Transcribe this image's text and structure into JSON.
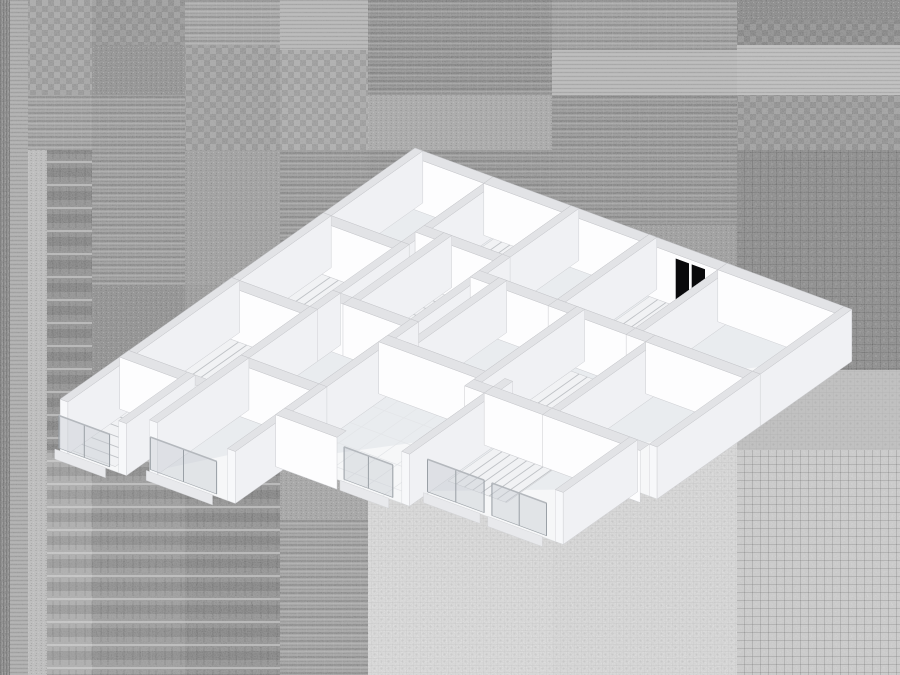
{
  "scene": {
    "width": 900,
    "height": 675,
    "description": "axonometric cutaway floor-plan model on glitch noise patchwork background"
  },
  "palette": {
    "wall_face": "#fdfdfe",
    "wall_side": "#f0f1f4",
    "wall_top": "#e2e3e6",
    "wall_cap": "#ececef",
    "wall_cap2": "#f7f8fa",
    "top_stroke": "#c5c6ca",
    "outline": "#cfd0d4",
    "floor": "#f6f7f8",
    "floor_stroke": "#dadcdf",
    "floor_shade": "#e6e8ec",
    "stair": "#f1f2f4",
    "stair_stroke": "#c7c9cc",
    "tread": "#bfc2c6",
    "door": "#0a0a0c",
    "glass": "#c7ccd2",
    "glass_frame": "#9aa0a6",
    "rail": "#b4b8bd",
    "curb": "#e8e9ec",
    "grid_line": "#e3e5e8"
  },
  "background": {
    "blocks": [
      [
        0,
        0,
        10,
        675,
        "#6f6f6f",
        "v3"
      ],
      [
        10,
        0,
        18,
        675,
        "#a6a6a6",
        "h4"
      ],
      [
        28,
        0,
        64,
        95,
        "#9b9b9b",
        "ch6"
      ],
      [
        28,
        95,
        64,
        55,
        "#999999",
        "h8"
      ],
      [
        28,
        150,
        19,
        525,
        "#c2c2c2",
        "fine"
      ],
      [
        47,
        150,
        45,
        300,
        "#7d7d7d",
        "rows22"
      ],
      [
        47,
        450,
        45,
        225,
        "#a8a8a8",
        "rows22"
      ],
      [
        92,
        0,
        93,
        45,
        "#8a8a8a",
        "ch6"
      ],
      [
        92,
        45,
        93,
        50,
        "#7e7e7e",
        "fine"
      ],
      [
        92,
        95,
        93,
        190,
        "#909090",
        "h8"
      ],
      [
        92,
        285,
        93,
        165,
        "#7b7b7b",
        "fine"
      ],
      [
        92,
        450,
        93,
        225,
        "#8d8d8d",
        "rows22"
      ],
      [
        185,
        0,
        95,
        45,
        "#a0a0a0",
        "h8"
      ],
      [
        185,
        45,
        95,
        105,
        "#979797",
        "ch6"
      ],
      [
        185,
        150,
        95,
        135,
        "#939393",
        "fine"
      ],
      [
        185,
        285,
        95,
        165,
        "#8c8c8c",
        "fine"
      ],
      [
        185,
        450,
        95,
        225,
        "#7e7e7e",
        "rows22"
      ],
      [
        280,
        0,
        88,
        50,
        "#b5b5b5",
        "h4"
      ],
      [
        280,
        50,
        88,
        100,
        "#a3a3a3",
        "ch6"
      ],
      [
        280,
        150,
        88,
        150,
        "#8d8d8d",
        "h8"
      ],
      [
        280,
        300,
        88,
        220,
        "#9c9c9c",
        "fine"
      ],
      [
        280,
        520,
        88,
        155,
        "#999999",
        "h8"
      ],
      [
        368,
        0,
        184,
        95,
        "#818181",
        "h8"
      ],
      [
        368,
        95,
        184,
        55,
        "#a2a2a2",
        "fine"
      ],
      [
        368,
        150,
        184,
        140,
        "#868686",
        "h8"
      ],
      [
        368,
        290,
        184,
        170,
        "#9b9b9b",
        "fine"
      ],
      [
        368,
        460,
        184,
        215,
        "#efefef",
        "dot6"
      ],
      [
        552,
        0,
        185,
        50,
        "#969696",
        "h8"
      ],
      [
        552,
        50,
        185,
        45,
        "#b9b9b9",
        "h4"
      ],
      [
        552,
        95,
        185,
        130,
        "#888888",
        "h8"
      ],
      [
        552,
        225,
        185,
        145,
        "#919191",
        "fine"
      ],
      [
        552,
        370,
        185,
        305,
        "#ececec",
        "dot6"
      ],
      [
        737,
        0,
        163,
        20,
        "#707070",
        "fine"
      ],
      [
        737,
        20,
        163,
        25,
        "#787878",
        "ch6"
      ],
      [
        737,
        45,
        163,
        50,
        "#c1c1c1",
        "h4"
      ],
      [
        737,
        95,
        163,
        55,
        "#8c8c8c",
        "ch6"
      ],
      [
        737,
        150,
        163,
        220,
        "#737373",
        "grid8"
      ],
      [
        737,
        370,
        163,
        80,
        "#c5c5c5",
        "dot6"
      ],
      [
        737,
        450,
        163,
        225,
        "#d8d8d8",
        "grid8"
      ]
    ]
  },
  "floorplan": {
    "origin": [
      415,
      200
    ],
    "axis_u": [
      19.5,
      7.2
    ],
    "axis_v": [
      -22.9,
      16.2
    ],
    "wall_height": 52,
    "wall_thickness": 0.4,
    "rooms": [
      [
        0,
        0,
        4,
        4,
        ""
      ],
      [
        4,
        0,
        4,
        3,
        ""
      ],
      [
        8,
        0,
        4,
        4,
        ""
      ],
      [
        12,
        0,
        4,
        4,
        ""
      ],
      [
        16,
        0,
        6,
        4,
        ""
      ],
      [
        0,
        4,
        4,
        4,
        ""
      ],
      [
        5,
        3,
        3,
        4,
        ""
      ],
      [
        9,
        4,
        4,
        4,
        ""
      ],
      [
        13,
        4,
        4,
        4.5,
        ""
      ],
      [
        17,
        4,
        5,
        4.5,
        ""
      ],
      [
        0,
        8,
        4,
        4.5,
        ""
      ],
      [
        4,
        7,
        4,
        4,
        ""
      ],
      [
        8,
        8,
        6,
        4.5,
        "sg"
      ],
      [
        14,
        8.5,
        7,
        3.25,
        "s"
      ],
      [
        0,
        12.5,
        3,
        3,
        "s"
      ],
      [
        4,
        11,
        4,
        4,
        "s"
      ]
    ],
    "extra_floors": [
      [
        4,
        4,
        1,
        3
      ]
    ],
    "walls_extra": [
      [
        "u",
        12.5,
        8,
        11.15
      ]
    ],
    "stairs": [
      [
        4.5,
        0.35,
        2.9,
        2.1,
        "u"
      ],
      [
        12.5,
        0.4,
        2.9,
        2.0,
        "u"
      ],
      [
        0.4,
        4.4,
        3.1,
        1.8,
        "u"
      ],
      [
        13.4,
        4.6,
        3.2,
        2.3,
        "u"
      ],
      [
        0.4,
        8.4,
        3.1,
        2.0,
        "u"
      ],
      [
        14.5,
        8.9,
        3.0,
        2.0,
        "u"
      ],
      [
        0.3,
        12.8,
        2.3,
        2.5,
        "v"
      ],
      [
        5.3,
        3.4,
        1.5,
        3.3,
        "v"
      ]
    ],
    "doors": [
      [
        "v",
        0,
        1.0,
        1.6
      ],
      [
        "v",
        8,
        0.7,
        1.5
      ],
      [
        "v",
        12,
        0.4,
        1.3
      ],
      [
        "u",
        0,
        13.9,
        1.5
      ],
      [
        "v",
        0,
        4.3,
        0.9
      ],
      [
        "v",
        0,
        8.3,
        0.9
      ],
      [
        "v",
        0,
        9.6,
        0.8
      ]
    ],
    "glass": [
      [
        "u",
        15.5,
        0.2,
        2.6
      ],
      [
        "u",
        15,
        4.3,
        3.4
      ],
      [
        "u",
        12.5,
        11.3,
        2.5
      ],
      [
        "u",
        11.75,
        14.7,
        2.9
      ],
      [
        "u",
        11.75,
        18.0,
        2.8
      ]
    ]
  }
}
